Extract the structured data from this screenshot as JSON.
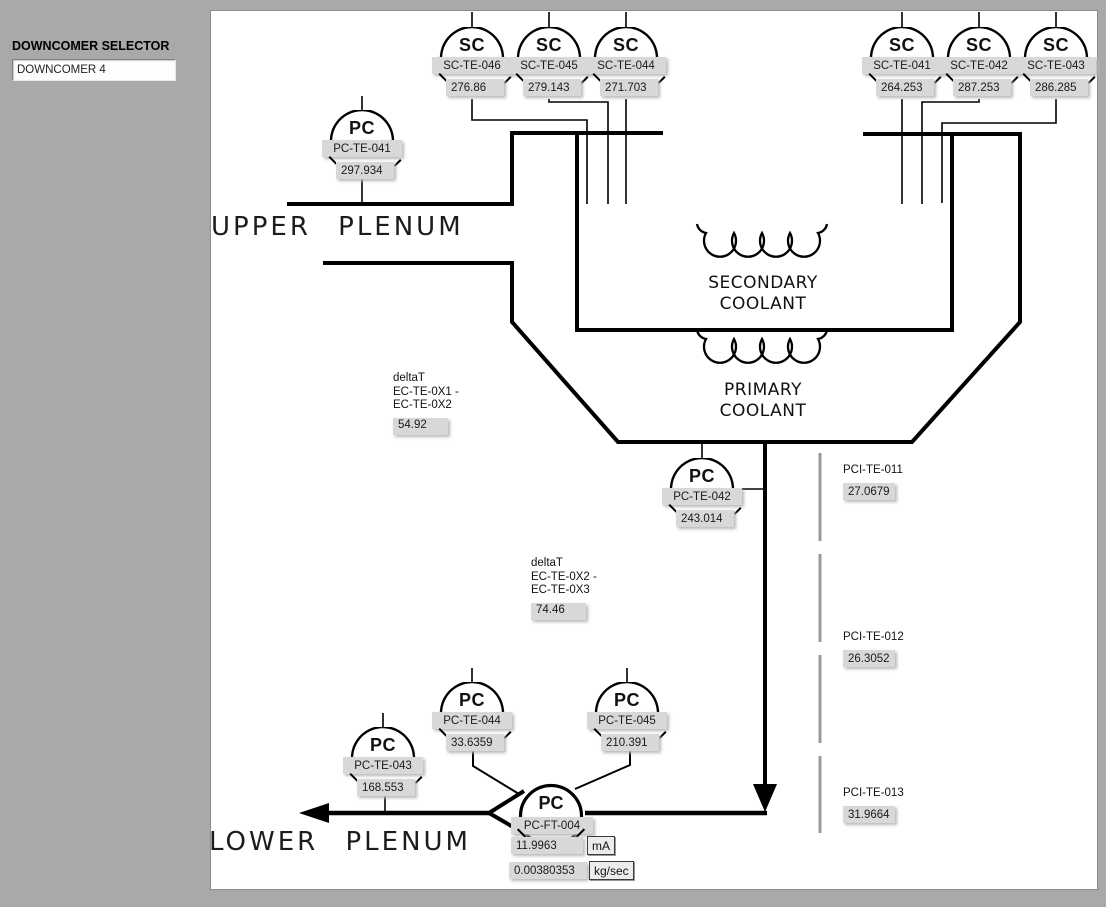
{
  "selector": {
    "label": "DOWNCOMER SELECTOR",
    "value": "DOWNCOMER 4"
  },
  "sensors": [
    {
      "type": "SC",
      "tag": "SC-TE-046",
      "value": "276.86"
    },
    {
      "type": "SC",
      "tag": "SC-TE-045",
      "value": "279.143"
    },
    {
      "type": "SC",
      "tag": "SC-TE-044",
      "value": "271.703"
    },
    {
      "type": "SC",
      "tag": "SC-TE-041",
      "value": "264.253"
    },
    {
      "type": "SC",
      "tag": "SC-TE-042",
      "value": "287.253"
    },
    {
      "type": "SC",
      "tag": "SC-TE-043",
      "value": "286.285"
    },
    {
      "type": "PC",
      "tag": "PC-TE-041",
      "value": "297.934"
    },
    {
      "type": "PC",
      "tag": "PC-TE-042",
      "value": "243.014"
    },
    {
      "type": "PC",
      "tag": "PC-TE-044",
      "value": "33.6359"
    },
    {
      "type": "PC",
      "tag": "PC-TE-045",
      "value": "210.391"
    },
    {
      "type": "PC",
      "tag": "PC-TE-043",
      "value": "168.553"
    }
  ],
  "flowmeter": {
    "type": "PC",
    "tag": "PC-FT-004",
    "current": "11.9963",
    "current_unit": "mA",
    "flow": "0.00380353",
    "flow_unit": "kg/sec"
  },
  "delta_t": [
    {
      "title": "deltaT",
      "line1": "EC-TE-0X1 -",
      "line2": "EC-TE-0X2",
      "value": "54.92"
    },
    {
      "title": "deltaT",
      "line1": "EC-TE-0X2 -",
      "line2": "EC-TE-0X3",
      "value": "74.46"
    }
  ],
  "pci": [
    {
      "tag": "PCI-TE-011",
      "value": "27.0679"
    },
    {
      "tag": "PCI-TE-012",
      "value": "26.3052"
    },
    {
      "tag": "PCI-TE-013",
      "value": "31.9664"
    }
  ],
  "labels": {
    "upper_plenum": "UPPER PLENUM",
    "lower_plenum": "LOWER PLENUM",
    "secondary1": "SECONDARY",
    "secondary2": "COOLANT",
    "primary1": "PRIMARY",
    "primary2": "COOLANT"
  },
  "colors": {
    "page_bg": "#a9a9a9",
    "canvas_bg": "#ffffff",
    "value_box": "#d8d8d8",
    "line": "#000000",
    "instrument_dash": "#9a9a9a"
  }
}
